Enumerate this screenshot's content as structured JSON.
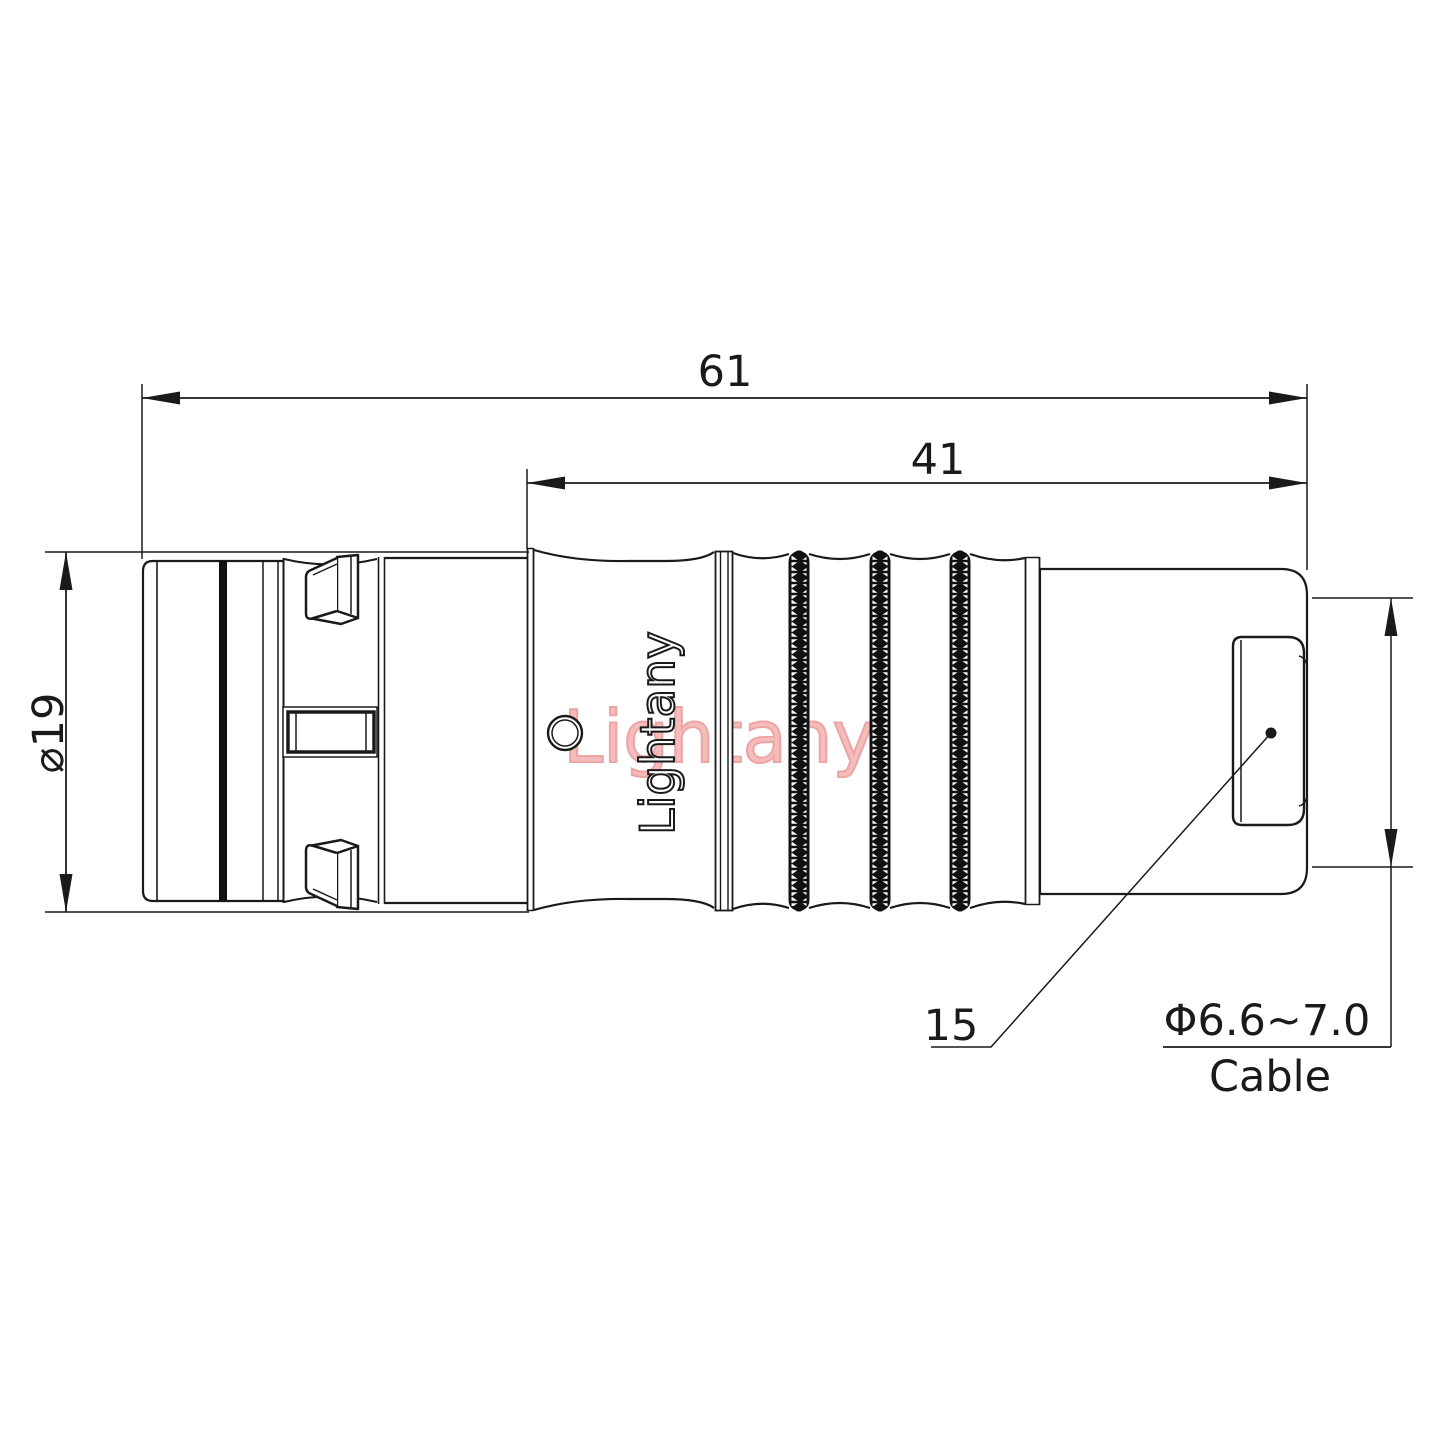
{
  "drawing": {
    "background": "#ffffff",
    "line_color": "#1a1a1a",
    "watermark": {
      "text": "Lightany",
      "color": "#f5bcbc",
      "stroke": "#eda4a4"
    },
    "engraving": {
      "text": "Lightany"
    },
    "dimensions": {
      "overall_length": "61",
      "rear_length": "41",
      "body_diameter": "⌀19",
      "boot_callout": "15",
      "cable_diameter": "Φ6.6~7.0",
      "cable_label": "Cable"
    }
  }
}
